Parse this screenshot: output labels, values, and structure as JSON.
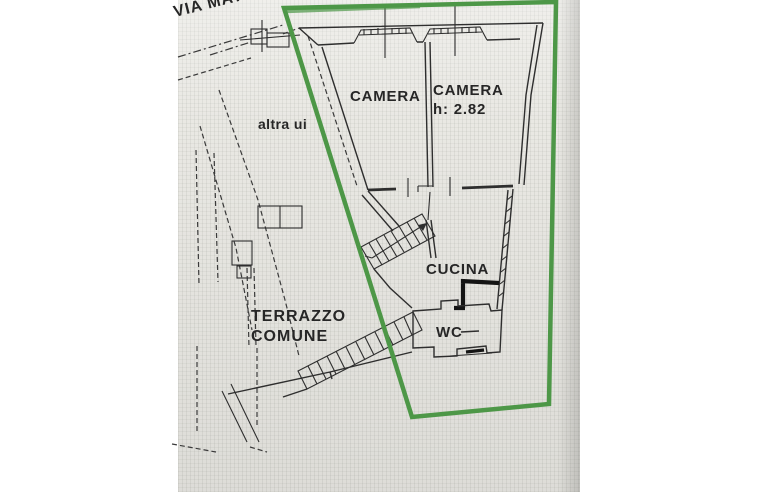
{
  "plan": {
    "street_label": "VIA MAT",
    "neighbor_label": "altra ui",
    "rooms": {
      "camera_left": "CAMERA",
      "camera_right": "CAMERA",
      "camera_right_height": "h: 2.82",
      "cucina": "CUCINA",
      "wc": "WC",
      "terrazzo_line1": "TERRAZZO",
      "terrazzo_line2": "COMUNE"
    },
    "colors": {
      "boundary_green": "#4d9747",
      "line_black": "#2e2e2e",
      "photo_background": "#e9e8e3",
      "page_background": "#ffffff"
    }
  }
}
